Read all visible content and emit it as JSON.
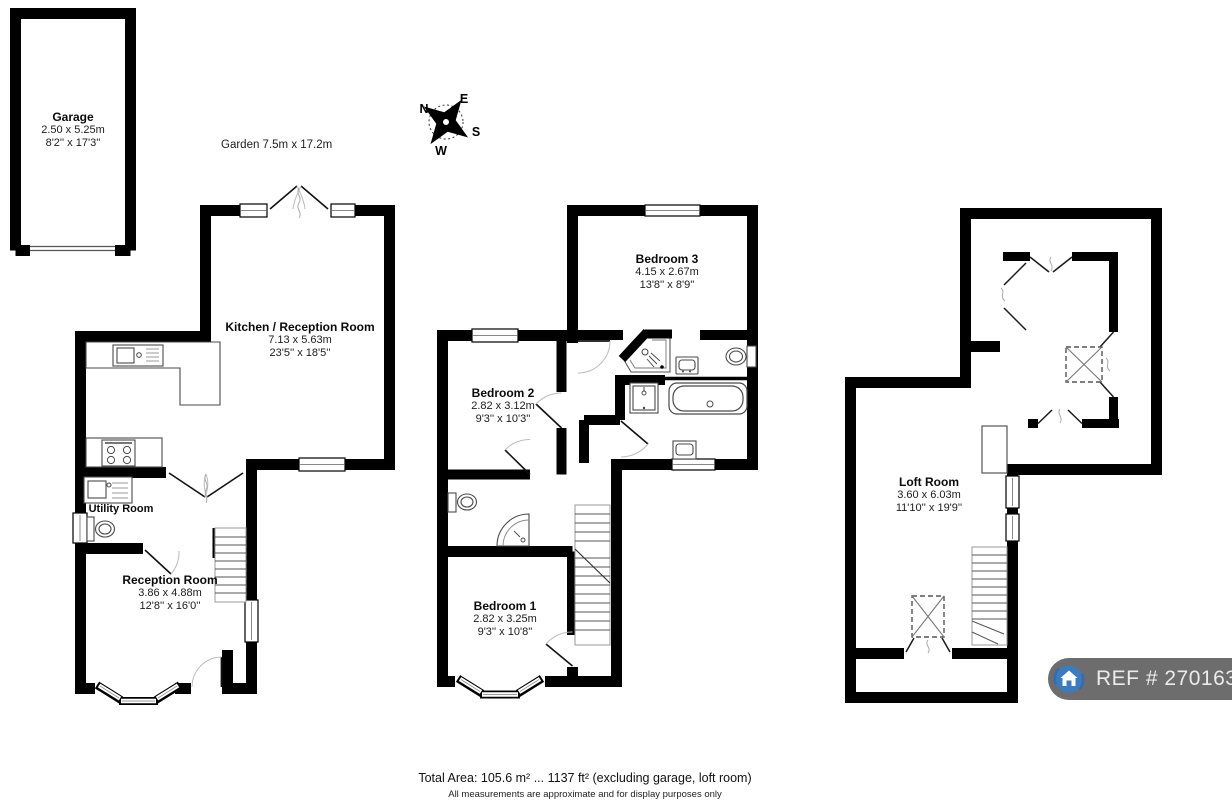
{
  "compass": {
    "north": "N",
    "east": "E",
    "south": "S",
    "west": "W"
  },
  "garden": {
    "label": "Garden 7.5m x 17.2m"
  },
  "rooms": {
    "garage": {
      "name": "Garage",
      "metric": "2.50 x 5.25m",
      "imperial": "8'2'' x 17'3''"
    },
    "kitchen_reception": {
      "name": "Kitchen / Reception Room",
      "metric": "7.13 x 5.63m",
      "imperial": "23'5'' x 18'5''"
    },
    "utility": {
      "name": "Utility Room"
    },
    "reception": {
      "name": "Reception Room",
      "metric": "3.86 x 4.88m",
      "imperial": "12'8'' x 16'0''"
    },
    "bedroom3": {
      "name": "Bedroom 3",
      "metric": "4.15 x 2.67m",
      "imperial": "13'8'' x 8'9''"
    },
    "bedroom2": {
      "name": "Bedroom 2",
      "metric": "2.82 x 3.12m",
      "imperial": "9'3'' x 10'3''"
    },
    "bedroom1": {
      "name": "Bedroom 1",
      "metric": "2.82 x 3.25m",
      "imperial": "9'3'' x 10'8''"
    },
    "loft": {
      "name": "Loft Room",
      "metric": "3.60 x 6.03m",
      "imperial": "11'10'' x 19'9''"
    }
  },
  "footer": {
    "total_area": "Total Area: 105.6 m² ... 1137 ft² (excluding garage, loft room)",
    "disclaimer": "All measurements are approximate and for display purposes only"
  },
  "ref_badge": {
    "text": "REF # 2701633"
  },
  "colors": {
    "wall": "#000000",
    "badge_bar": "#6d6d6d",
    "badge_logo_blue": "#3b7cc0",
    "fixture_line": "#4a4a4a"
  }
}
